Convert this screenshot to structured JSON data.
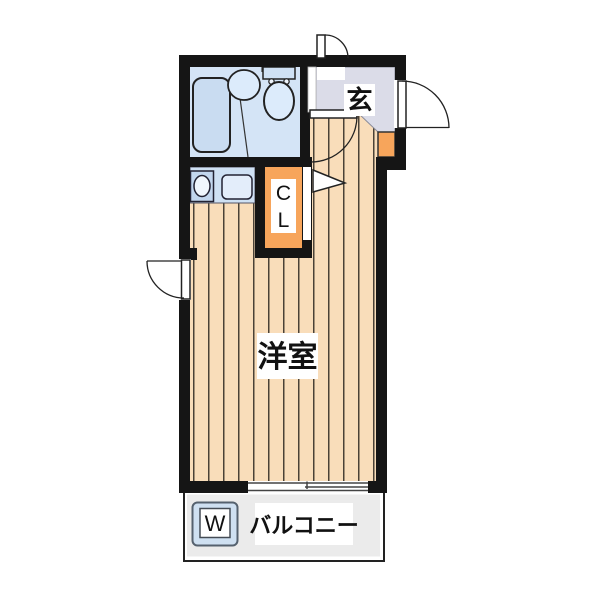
{
  "floor_plan": {
    "labels": {
      "entrance": "玄",
      "closet_top": "C",
      "closet_bottom": "L",
      "main_room": "洋室",
      "balcony": "バルコニー",
      "washing_machine": "W"
    },
    "colors": {
      "wall": "#151515",
      "wood_floor": "#f9ddba",
      "wood_stripe": "#4b4237",
      "bathroom": "#d4e4f6",
      "bathtub": "#c9dcf1",
      "fixture_light": "#dcebfb",
      "toilet_tank": "#cfe1f4",
      "kitchen_counter": "#cfe1f4",
      "kitchen_sink": "#c2d6ee",
      "kitchen_stove": "#e3edfa",
      "closet_orange": "#f7a55b",
      "entrance_floor": "#dbdce8",
      "entrance_step_orange": "#f7a55b",
      "balcony_gray": "#ebebeb",
      "washer_box": "#cfe0f1",
      "label_text": "#111111"
    }
  }
}
